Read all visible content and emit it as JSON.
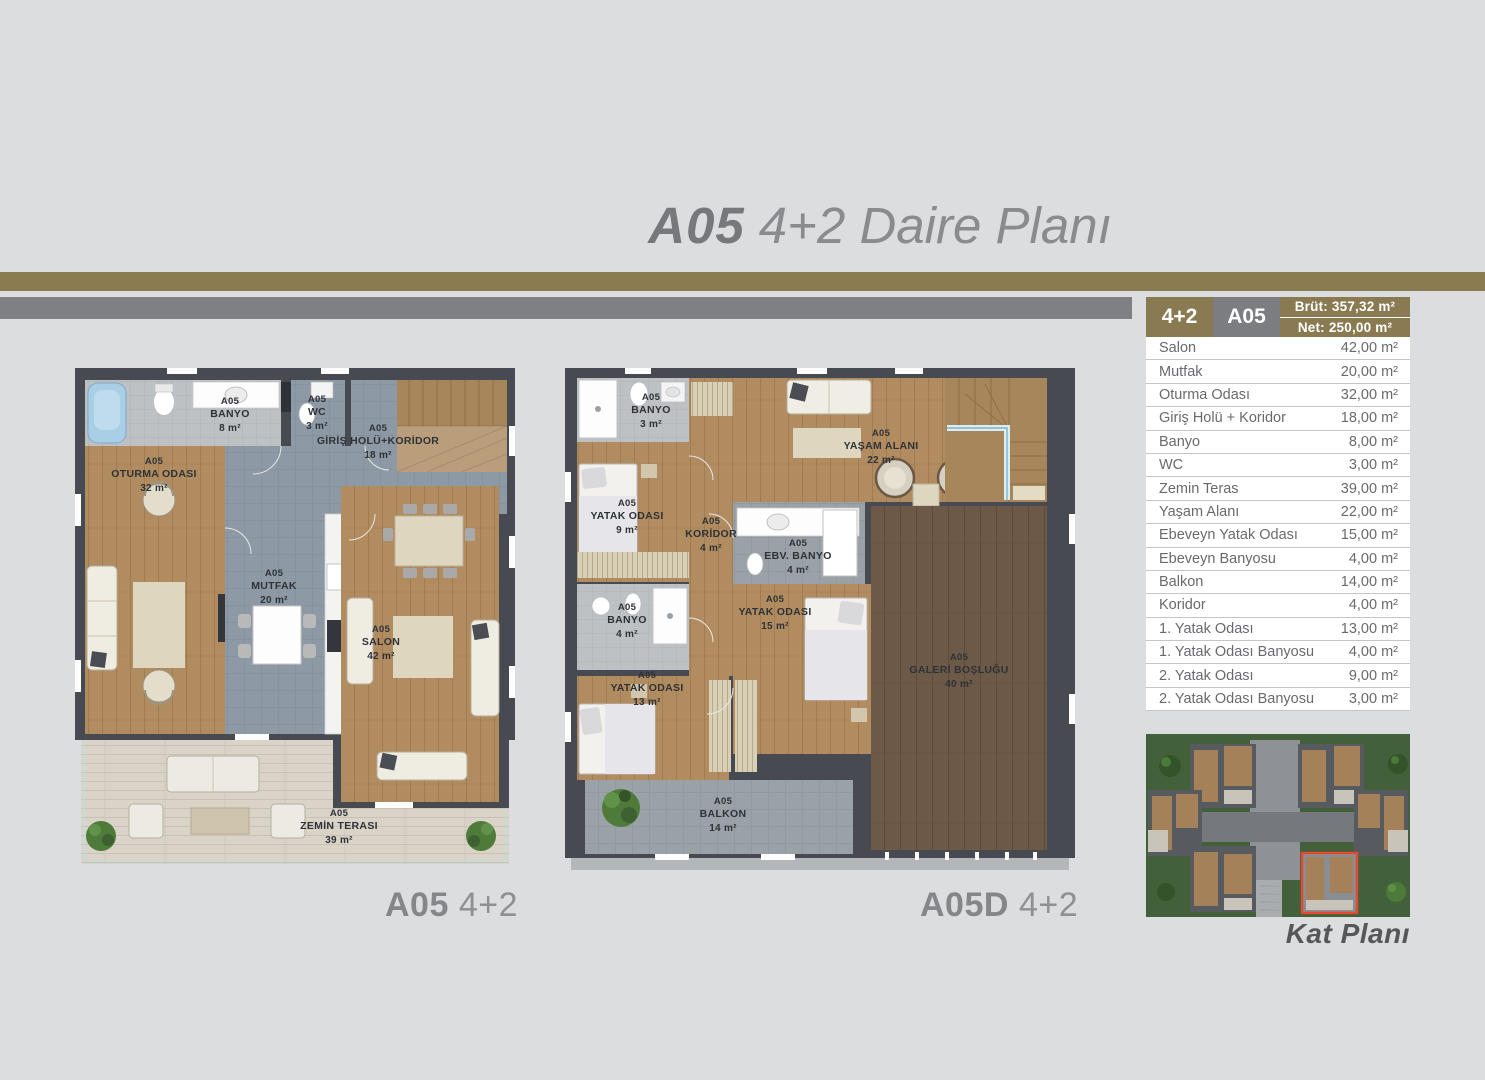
{
  "header": {
    "code": "A05",
    "title": "4+2 Daire Planı"
  },
  "summary": {
    "type": "4+2",
    "unit": "A05",
    "brut": "Brüt: 357,32 m²",
    "net": "Net: 250,00 m²",
    "rows": [
      {
        "label": "Salon",
        "area": "42,00 m²"
      },
      {
        "label": "Mutfak",
        "area": "20,00 m²"
      },
      {
        "label": "Oturma Odası",
        "area": "32,00 m²"
      },
      {
        "label": "Giriş Holü + Koridor",
        "area": "18,00 m²"
      },
      {
        "label": "Banyo",
        "area": "8,00 m²"
      },
      {
        "label": "WC",
        "area": "3,00 m²"
      },
      {
        "label": "Zemin Teras",
        "area": "39,00 m²"
      },
      {
        "label": "Yaşam Alanı",
        "area": "22,00 m²"
      },
      {
        "label": "Ebeveyn Yatak Odası",
        "area": "15,00 m²"
      },
      {
        "label": "Ebeveyn Banyosu",
        "area": "4,00 m²"
      },
      {
        "label": "Balkon",
        "area": "14,00 m²"
      },
      {
        "label": "Koridor",
        "area": "4,00 m²"
      },
      {
        "label": "1. Yatak Odası",
        "area": "13,00 m²"
      },
      {
        "label": "1. Yatak Odası Banyosu",
        "area": "4,00 m²"
      },
      {
        "label": "2. Yatak Odası",
        "area": "9,00 m²"
      },
      {
        "label": "2. Yatak Odası Banyosu",
        "area": "3,00 m²"
      }
    ]
  },
  "plans": [
    {
      "caption_code": "A05",
      "caption_suffix": "4+2",
      "rooms": [
        {
          "code": "A05",
          "name": "BANYO",
          "area": "8 m²"
        },
        {
          "code": "A05",
          "name": "WC",
          "area": "3 m²"
        },
        {
          "code": "A05",
          "name": "GİRİŞ HOLÜ+KORİDOR",
          "area": "18 m²"
        },
        {
          "code": "A05",
          "name": "OTURMA ODASI",
          "area": "32 m²"
        },
        {
          "code": "A05",
          "name": "MUTFAK",
          "area": "20 m²"
        },
        {
          "code": "A05",
          "name": "SALON",
          "area": "42 m²"
        },
        {
          "code": "A05",
          "name": "ZEMİN TERASI",
          "area": "39 m²"
        }
      ]
    },
    {
      "caption_code": "A05D",
      "caption_suffix": "4+2",
      "rooms": [
        {
          "code": "A05",
          "name": "BANYO",
          "area": "3 m²"
        },
        {
          "code": "A05",
          "name": "YATAK ODASI",
          "area": "9 m²"
        },
        {
          "code": "A05",
          "name": "KORİDOR",
          "area": "4 m²"
        },
        {
          "code": "A05",
          "name": "EBV. BANYO",
          "area": "4 m²"
        },
        {
          "code": "A05",
          "name": "YAŞAM ALANI",
          "area": "22 m²"
        },
        {
          "code": "A05",
          "name": "BANYO",
          "area": "4 m²"
        },
        {
          "code": "A05",
          "name": "YATAK ODASI",
          "area": "15 m²"
        },
        {
          "code": "A05",
          "name": "YATAK ODASI",
          "area": "13 m²"
        },
        {
          "code": "A05",
          "name": "BALKON",
          "area": "14 m²"
        },
        {
          "code": "A05",
          "name": "GALERİ BOŞLUĞU",
          "area": "40 m²"
        }
      ]
    }
  ],
  "site_map": {
    "caption": "Kat Planı"
  }
}
